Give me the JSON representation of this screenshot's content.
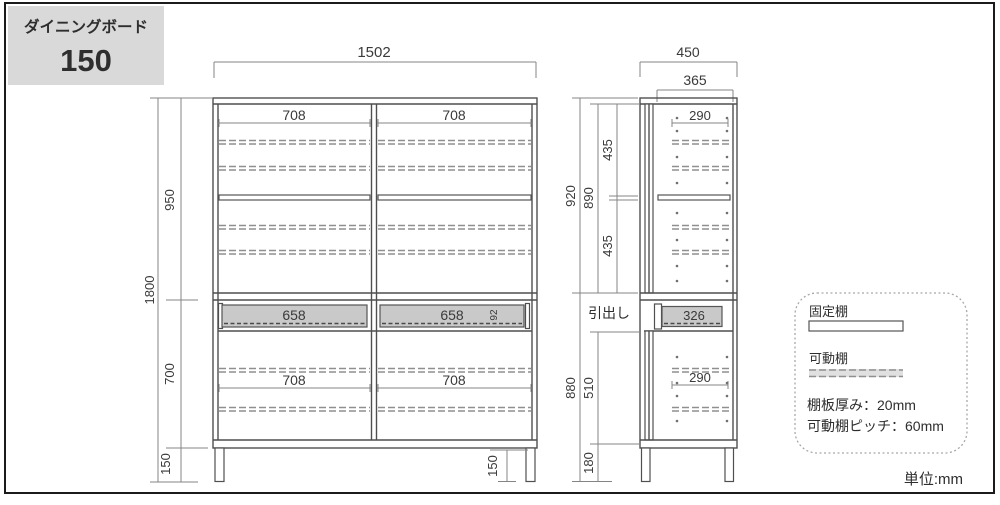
{
  "title_box": {
    "series": "ダイニングボード",
    "size": "150"
  },
  "front": {
    "total_width": "1502",
    "total_height": "1800",
    "upper_height": "950",
    "lower_height": "700",
    "leg_height": "150",
    "right_leg_height": "150",
    "compartment_widths": [
      "708",
      "708",
      "708",
      "708"
    ],
    "drawer_widths": [
      "658",
      "658"
    ],
    "drawer_inner_height": "92"
  },
  "side": {
    "total_depth": "450",
    "inner_depth": "365",
    "upper_shelf_depth": "290",
    "lower_shelf_depth": "290",
    "upper_height": "920",
    "upper_inner_height": "890",
    "upper_space_heights": [
      "435",
      "435"
    ],
    "lower_height": "880",
    "lower_inner_height": "510",
    "leg_height": "180",
    "drawer_depth": "326",
    "drawer_callout": "引出し"
  },
  "legend": {
    "fixed_shelf": "固定棚",
    "movable_shelf": "可動棚",
    "notes": [
      "棚板厚み：20mm",
      "可動棚ピッチ：60mm"
    ]
  },
  "unit": "単位:mm"
}
